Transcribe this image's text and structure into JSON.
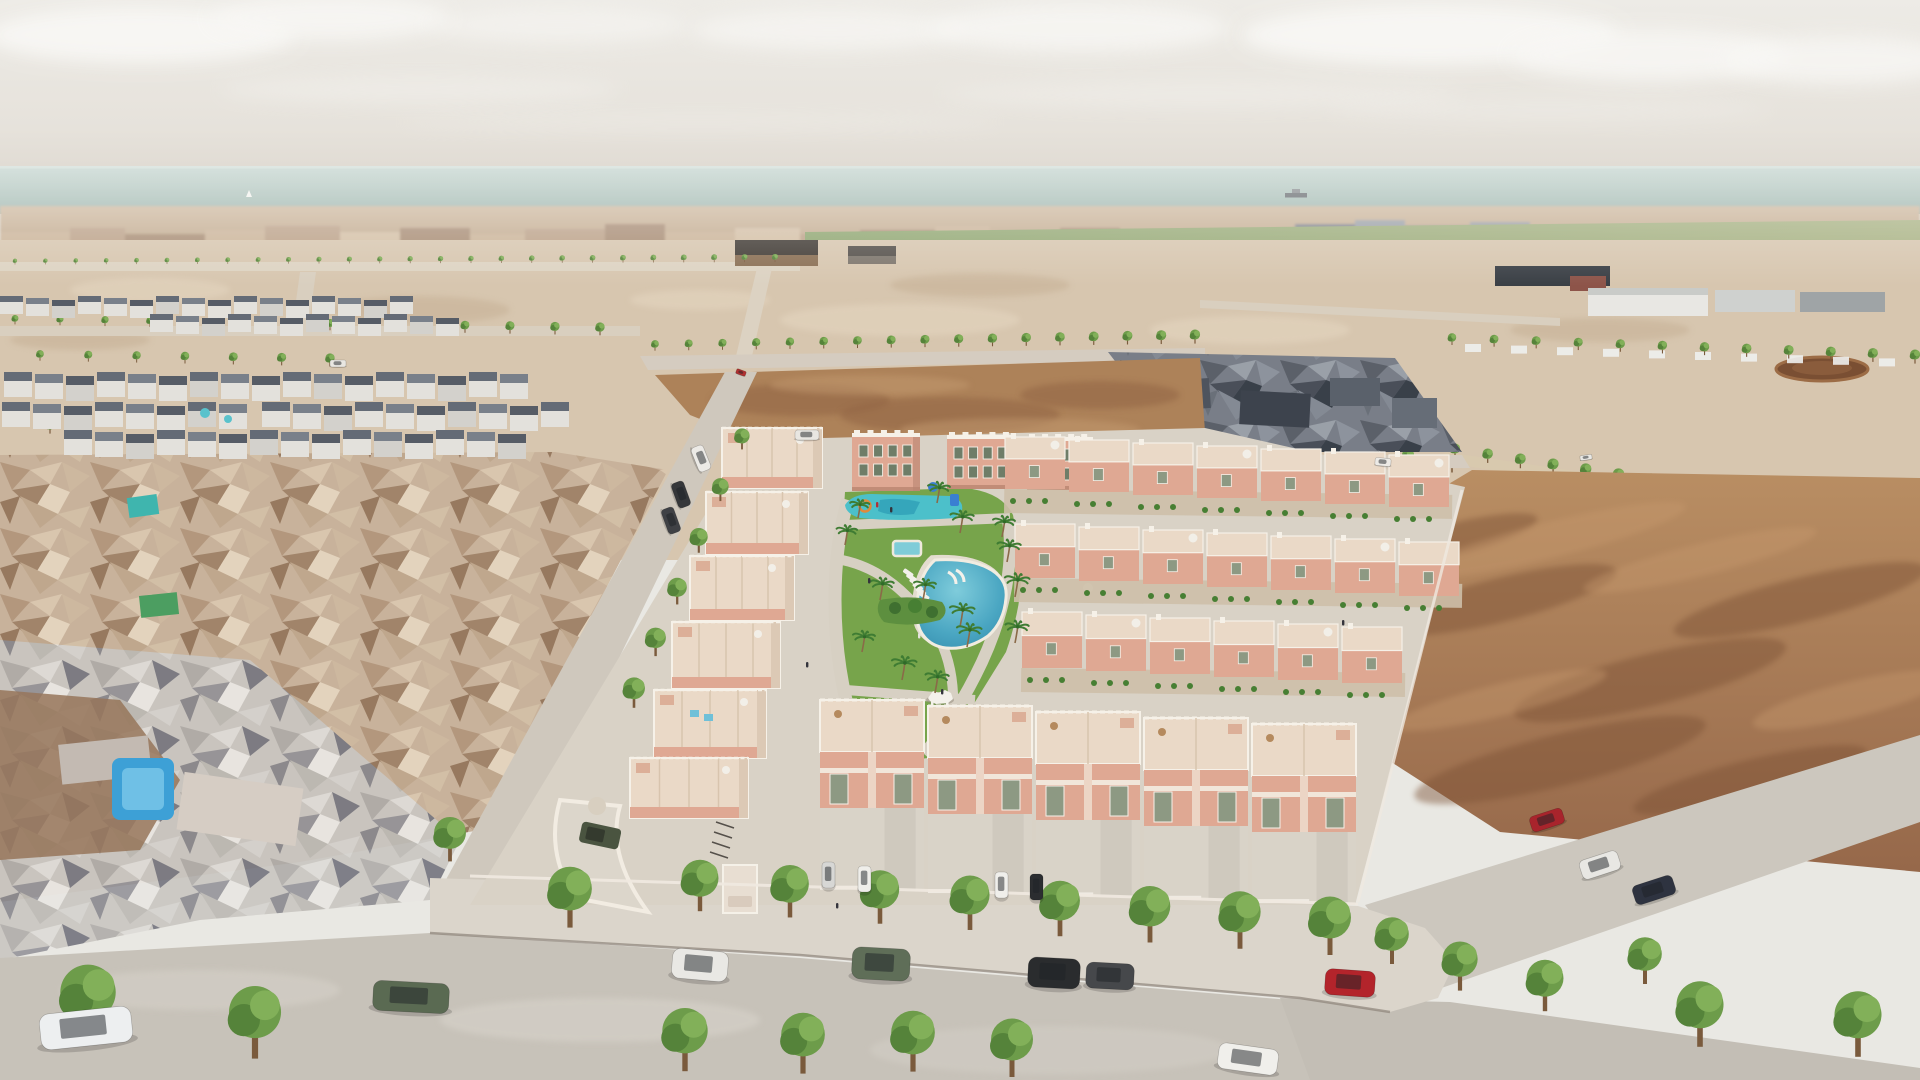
{
  "meta": {
    "title": "Aerial 3D architectural rendering of a coastal new-build residential development",
    "type": "architectural-visualization-render",
    "width": 1920,
    "height": 1080
  },
  "scene": {
    "description": "Bird's-eye daytime render of a gated new-build complex of salmon-pink townhouses and small apartment blocks arranged around a landscaped central park with a lagoon-style pool, a children's splash pool, a small rectangular pool and palm trees. An existing low-poly photogrammetry town sits to the west, vacant brown land to the east, farmland, greenhouses and industrial sheds in the midground, and a distant Mediterranean town with the sea, a cargo ship and a sailboat on the horizon. Tree-lined streets with parked cars border the development in the foreground.",
    "time_of_day": "hazy daylight",
    "counts": {
      "pools_in_park": 3,
      "apartment_towers": 3,
      "street_trees_foreground": 10,
      "parked_cars_foreground": 8
    }
  },
  "palette": {
    "skyTop": "#edebe6",
    "skyHorizon": "#e0dbd3",
    "cloud": "#f8f7f4",
    "seaTop": "#b4c9c1",
    "seaBottom": "#9ab2aa",
    "horizonLight": "#ccd8d1",
    "cityTan": "#c9b299",
    "industrialSlate": "#5d6570",
    "orchardGreen": "#7e9355",
    "fieldGreen": "#a3b07e",
    "sandLight": "#d7c6af",
    "sandPath": "#ddd3c2",
    "dirtBrown": "#a87c57",
    "dirtDark": "#8a603f",
    "dirtLight": "#c09a71",
    "roadGray": "#c7c2b9",
    "sidewalk": "#dbd5cb",
    "paving": "#d9d2c6",
    "curb": "#8d8379",
    "salmonWall": "#dfa893",
    "salmonShade": "#c8937f",
    "creamRoof": "#ead9c7",
    "whiteTrim": "#f6f1e8",
    "windowGreen": "#8d9983",
    "windowDark": "#6f7d68",
    "lawnGreen": "#77a44b",
    "bushGreen": "#477f33",
    "splashTeal": "#4cc0ca",
    "poolDeep": "#2f86a8",
    "poolMid": "#4aa6c2",
    "poolLight": "#7fccdb",
    "oldTownPool": "#3da0d6",
    "treeGreen": "#6d9c4a",
    "treeDark": "#55833a",
    "treeLight": "#82b059",
    "palmGreen": "#3f7c33",
    "trunkBrown": "#7a5a3c"
  },
  "objects": {
    "clouds": [
      [
        140,
        35,
        155,
        28,
        0.95
      ],
      [
        330,
        18,
        120,
        22,
        0.85
      ],
      [
        560,
        25,
        130,
        18,
        0.55
      ],
      [
        830,
        30,
        140,
        20,
        0.7
      ],
      [
        1080,
        28,
        150,
        24,
        0.8
      ],
      [
        1430,
        35,
        190,
        30,
        0.95
      ],
      [
        1650,
        55,
        140,
        26,
        0.85
      ],
      [
        1840,
        60,
        120,
        24,
        0.8
      ],
      [
        420,
        90,
        200,
        14,
        0.35
      ],
      [
        1200,
        95,
        260,
        14,
        0.3
      ],
      [
        700,
        122,
        300,
        10,
        0.22
      ],
      [
        1550,
        110,
        220,
        12,
        0.25
      ]
    ],
    "vessels": {
      "cargo_ship": {
        "x": 1296,
        "y": 196
      },
      "sailboat": {
        "x": 249,
        "y": 197
      }
    },
    "skyline": {
      "colors": [
        "#bca189",
        "#cbb49a",
        "#a88c75",
        "#d5c1a8",
        "#9aa0a8",
        "#7e848e"
      ],
      "segments": [
        [
          0,
          70,
          12,
          1
        ],
        [
          70,
          55,
          16,
          0
        ],
        [
          125,
          80,
          10,
          2
        ],
        [
          205,
          60,
          14,
          1
        ],
        [
          265,
          75,
          18,
          0
        ],
        [
          340,
          60,
          12,
          3
        ],
        [
          400,
          70,
          16,
          2
        ],
        [
          470,
          55,
          10,
          1
        ],
        [
          525,
          80,
          15,
          0
        ],
        [
          605,
          60,
          20,
          2
        ],
        [
          665,
          70,
          12,
          1
        ],
        [
          735,
          65,
          16,
          3
        ],
        [
          800,
          60,
          10,
          0
        ],
        [
          860,
          75,
          14,
          2
        ],
        [
          935,
          55,
          18,
          1
        ],
        [
          990,
          70,
          12,
          0
        ],
        [
          1060,
          60,
          16,
          2
        ],
        [
          1120,
          70,
          10,
          1
        ],
        [
          1190,
          60,
          14,
          3
        ],
        [
          1250,
          45,
          12,
          0
        ],
        [
          1295,
          60,
          20,
          5
        ],
        [
          1355,
          50,
          24,
          4
        ],
        [
          1405,
          65,
          18,
          5
        ],
        [
          1470,
          60,
          22,
          4
        ],
        [
          1530,
          70,
          14,
          1
        ],
        [
          1600,
          70,
          16,
          4
        ],
        [
          1670,
          60,
          12,
          1
        ],
        [
          1730,
          70,
          14,
          2
        ],
        [
          1800,
          60,
          12,
          4
        ],
        [
          1860,
          60,
          14,
          2
        ]
      ]
    },
    "treeRows": [
      {
        "name": "orchard-palm-row",
        "layer": "far",
        "x0": 15,
        "y0": 263,
        "x1": 775,
        "y1": 260,
        "n": 26,
        "s0": 5,
        "s1": 7
      },
      {
        "name": "upper-left-row",
        "layer": "far",
        "x0": 15,
        "y0": 322,
        "x1": 600,
        "y1": 332,
        "n": 14,
        "s0": 8,
        "s1": 11
      },
      {
        "name": "upper-left-row2",
        "layer": "far",
        "x0": 40,
        "y0": 358,
        "x1": 330,
        "y1": 363,
        "n": 7,
        "s0": 9,
        "s1": 11
      },
      {
        "name": "top-road-row",
        "layer": "far",
        "x0": 655,
        "y0": 348,
        "x1": 1195,
        "y1": 340,
        "n": 17,
        "s0": 9,
        "s1": 12
      },
      {
        "name": "ne-cluster-road-row",
        "layer": "far",
        "x0": 1232,
        "y0": 436,
        "x1": 1452,
        "y1": 468,
        "n": 6,
        "s0": 12,
        "s1": 15
      },
      {
        "name": "stall-row",
        "layer": "far",
        "x0": 1452,
        "y0": 342,
        "x1": 1915,
        "y1": 360,
        "n": 12,
        "s0": 10,
        "s1": 12
      },
      {
        "name": "east-road-row",
        "layer": "far",
        "x0": 1455,
        "y0": 454,
        "x1": 1880,
        "y1": 522,
        "n": 14,
        "s0": 12,
        "s1": 16
      },
      {
        "name": "field-west-edge-row",
        "layer": "far",
        "x0": 1362,
        "y0": 560,
        "x1": 1398,
        "y1": 730,
        "n": 5,
        "s0": 16,
        "s1": 20
      },
      {
        "name": "left-road-row",
        "layer": "near",
        "x0": 742,
        "y0": 444,
        "x1": 634,
        "y1": 700,
        "n": 6,
        "s0": 18,
        "s1": 26
      },
      {
        "name": "sidewalk-row",
        "layer": "near",
        "x0": 700,
        "y0": 898,
        "x1": 1330,
        "y1": 940,
        "n": 8,
        "s0": 44,
        "s1": 50
      }
    ],
    "treesFar": [
      [
        50,
        430,
        12
      ],
      [
        88,
        520,
        14
      ],
      [
        205,
        468,
        13
      ],
      [
        262,
        558,
        16
      ],
      [
        325,
        608,
        16
      ],
      [
        152,
        648,
        15
      ],
      [
        232,
        688,
        15
      ],
      [
        332,
        718,
        16
      ],
      [
        422,
        658,
        15
      ],
      [
        392,
        478,
        12
      ],
      [
        468,
        418,
        11
      ],
      [
        520,
        562,
        14
      ],
      [
        480,
        612,
        15
      ],
      [
        545,
        500,
        13
      ],
      [
        820,
        505,
        12
      ],
      [
        812,
        560,
        13
      ],
      [
        800,
        615,
        14
      ],
      [
        790,
        672,
        15
      ],
      [
        782,
        725,
        15
      ],
      [
        1170,
        472,
        12
      ],
      [
        1210,
        488,
        12
      ],
      [
        1310,
        472,
        11
      ],
      [
        1425,
        498,
        12
      ],
      [
        1500,
        532,
        13
      ]
    ],
    "treesNear": [
      [
        88,
        1022,
        66
      ],
      [
        255,
        1040,
        62
      ],
      [
        450,
        850,
        38
      ],
      [
        570,
        912,
        52
      ],
      [
        685,
        1055,
        54
      ],
      [
        803,
        1058,
        52
      ],
      [
        913,
        1056,
        52
      ],
      [
        1012,
        1062,
        50
      ],
      [
        1392,
        952,
        40
      ],
      [
        1460,
        978,
        42
      ],
      [
        1545,
        998,
        44
      ],
      [
        1645,
        972,
        40
      ],
      [
        1700,
        1030,
        56
      ],
      [
        1858,
        1040,
        56
      ]
    ],
    "palms": [
      [
        937,
        503,
        16
      ],
      [
        960,
        533,
        17
      ],
      [
        1002,
        537,
        16
      ],
      [
        1007,
        562,
        17
      ],
      [
        1015,
        597,
        18
      ],
      [
        880,
        600,
        17
      ],
      [
        923,
        600,
        16
      ],
      [
        960,
        627,
        18
      ],
      [
        967,
        647,
        18
      ],
      [
        1015,
        643,
        17
      ],
      [
        862,
        652,
        16
      ],
      [
        845,
        545,
        15
      ],
      [
        858,
        518,
        14
      ],
      [
        902,
        680,
        18
      ],
      [
        935,
        693,
        17
      ]
    ],
    "cars": [
      {
        "x": 373,
        "y": 982,
        "w": 76,
        "h": 30,
        "c": "#5a6a52",
        "r": 3,
        "kind": "green-suv"
      },
      {
        "x": 672,
        "y": 950,
        "w": 56,
        "h": 30,
        "c": "#e9e8e4",
        "r": 5,
        "kind": "white-suv"
      },
      {
        "x": 852,
        "y": 948,
        "w": 58,
        "h": 32,
        "c": "#5f6e58",
        "r": 3,
        "kind": "green-suv"
      },
      {
        "x": 1028,
        "y": 958,
        "w": 52,
        "h": 30,
        "c": "#2a2c2e",
        "r": 3,
        "kind": "black-suv"
      },
      {
        "x": 1086,
        "y": 963,
        "w": 48,
        "h": 26,
        "c": "#46484b",
        "r": 3,
        "kind": "gray-sedan"
      },
      {
        "x": 1325,
        "y": 970,
        "w": 50,
        "h": 26,
        "c": "#b3242b",
        "r": 4,
        "kind": "red-hatchback"
      },
      {
        "x": 1218,
        "y": 1046,
        "w": 60,
        "h": 26,
        "c": "#f0efeb",
        "r": 8,
        "kind": "white-coupe"
      },
      {
        "x": 40,
        "y": 1010,
        "w": 92,
        "h": 36,
        "c": "#edeff0",
        "r": -6,
        "kind": "white-sports-car"
      },
      {
        "x": 688,
        "y": 452,
        "w": 26,
        "h": 13,
        "c": "#eceae6",
        "r": 68,
        "kind": "white-pickup"
      },
      {
        "x": 668,
        "y": 488,
        "w": 26,
        "h": 13,
        "c": "#35373a",
        "r": 70,
        "kind": "dark-suv"
      },
      {
        "x": 658,
        "y": 514,
        "w": 26,
        "h": 13,
        "c": "#3f4145",
        "r": 70,
        "kind": "dark-suv"
      },
      {
        "x": 736,
        "y": 370,
        "w": 10,
        "h": 5,
        "c": "#b03030",
        "r": 20,
        "kind": "distant-red-car"
      },
      {
        "x": 1580,
        "y": 855,
        "w": 40,
        "h": 20,
        "c": "#e8e7e3",
        "r": -18,
        "kind": "white-sedan"
      },
      {
        "x": 1633,
        "y": 880,
        "w": 42,
        "h": 20,
        "c": "#2e3340",
        "r": -18,
        "kind": "dark-sedan"
      },
      {
        "x": 1530,
        "y": 812,
        "w": 34,
        "h": 16,
        "c": "#a8242c",
        "r": -18,
        "kind": "red-car"
      },
      {
        "x": 822,
        "y": 862,
        "w": 13,
        "h": 26,
        "c": "#d7d7d5",
        "r": 0,
        "kind": "driveway-car"
      },
      {
        "x": 858,
        "y": 866,
        "w": 13,
        "h": 26,
        "c": "#efeeea",
        "r": 0,
        "kind": "driveway-car"
      },
      {
        "x": 995,
        "y": 872,
        "w": 13,
        "h": 26,
        "c": "#f0efeb",
        "r": 0,
        "kind": "driveway-car"
      },
      {
        "x": 1030,
        "y": 874,
        "w": 13,
        "h": 26,
        "c": "#2b2d30",
        "r": 0,
        "kind": "driveway-car"
      },
      {
        "x": 330,
        "y": 360,
        "w": 16,
        "h": 7,
        "c": "#e9e7e2",
        "r": 0,
        "kind": "distant-white-car"
      },
      {
        "x": 795,
        "y": 430,
        "w": 24,
        "h": 10,
        "c": "#e8e6e1",
        "r": 0,
        "kind": "white-van"
      },
      {
        "x": 1580,
        "y": 455,
        "w": 12,
        "h": 5,
        "c": "#e9e8e4",
        "r": -8,
        "kind": "distant-white-car"
      },
      {
        "x": 1375,
        "y": 458,
        "w": 16,
        "h": 8,
        "c": "#eceae6",
        "r": 5,
        "kind": "distant-white-car"
      }
    ],
    "apartments": {
      "towers": [
        {
          "x": 852,
          "y": 433,
          "w": 68,
          "h": 58
        },
        {
          "x": 947,
          "y": 435,
          "w": 68,
          "h": 54
        },
        {
          "x": 1027,
          "y": 437,
          "w": 66,
          "h": 53
        }
      ]
    },
    "leftBlocks": [
      {
        "x": 722,
        "y": 428,
        "w": 100,
        "h": 60
      },
      {
        "x": 706,
        "y": 492,
        "w": 102,
        "h": 62
      },
      {
        "x": 690,
        "y": 556,
        "w": 104,
        "h": 64
      },
      {
        "x": 672,
        "y": 622,
        "w": 108,
        "h": 66
      },
      {
        "x": 654,
        "y": 690,
        "w": 112,
        "h": 68
      },
      {
        "x": 630,
        "y": 758,
        "w": 118,
        "h": 60
      }
    ],
    "gridRows": [
      {
        "x": 1005,
        "y": 437,
        "n": 7,
        "uw": 64,
        "uh": 52,
        "tilt": 3
      },
      {
        "x": 1015,
        "y": 524,
        "n": 7,
        "uw": 64,
        "uh": 54,
        "tilt": 3
      },
      {
        "x": 1022,
        "y": 612,
        "n": 6,
        "uw": 64,
        "uh": 56,
        "tilt": 3
      }
    ],
    "bottomUnits": [
      {
        "x": 820,
        "y": 700
      },
      {
        "x": 928,
        "y": 706
      },
      {
        "x": 1036,
        "y": 712
      },
      {
        "x": 1144,
        "y": 718
      },
      {
        "x": 1252,
        "y": 724
      }
    ],
    "oldTownRows": [
      {
        "x": 0,
        "y": 296,
        "n": 16,
        "w": 26,
        "face": 12,
        "roof": 6
      },
      {
        "x": 150,
        "y": 314,
        "n": 12,
        "w": 26,
        "face": 12,
        "roof": 6
      },
      {
        "x": 4,
        "y": 372,
        "n": 17,
        "w": 31,
        "face": 16,
        "roof": 9
      },
      {
        "x": 262,
        "y": 402,
        "n": 10,
        "w": 31,
        "face": 16,
        "roof": 9
      },
      {
        "x": 2,
        "y": 402,
        "n": 8,
        "w": 31,
        "face": 16,
        "roof": 9
      },
      {
        "x": 64,
        "y": 430,
        "n": 15,
        "w": 31,
        "face": 16,
        "roof": 9
      }
    ],
    "loungers": {
      "x": 905,
      "y": 568,
      "n": 6,
      "dx": 3.2,
      "dy": 4.6,
      "rot": 35
    },
    "people": [
      [
        876,
        502,
        "#b03038"
      ],
      [
        890,
        507,
        "#34343c"
      ],
      [
        868,
        578,
        "#34343c"
      ],
      [
        918,
        633,
        "#e6e4de"
      ],
      [
        941,
        689,
        "#34343c"
      ],
      [
        806,
        662,
        "#34343c"
      ],
      [
        836,
        903,
        "#34343c"
      ],
      [
        1342,
        620,
        "#34343c"
      ]
    ],
    "midMottles": [
      [
        150,
        290,
        80,
        12,
        1
      ],
      [
        420,
        310,
        90,
        14,
        0
      ],
      [
        700,
        300,
        70,
        10,
        1
      ],
      [
        980,
        285,
        90,
        12,
        0
      ],
      [
        1250,
        330,
        100,
        14,
        1
      ],
      [
        1600,
        330,
        90,
        12,
        0
      ],
      [
        900,
        320,
        120,
        16,
        1
      ],
      [
        80,
        340,
        70,
        10,
        0
      ]
    ],
    "fieldStreaks": {
      "dark": [
        [
          1500,
          600,
          120,
          22
        ],
        [
          1650,
          680,
          140,
          26
        ],
        [
          1800,
          600,
          130,
          22
        ],
        [
          1560,
          760,
          150,
          26
        ],
        [
          1750,
          780,
          120,
          20
        ],
        [
          1450,
          540,
          90,
          16
        ]
      ],
      "light": [
        [
          1550,
          540,
          140,
          18
        ],
        [
          1700,
          560,
          120,
          16
        ],
        [
          1850,
          700,
          100,
          18
        ],
        [
          1500,
          700,
          110,
          16
        ]
      ]
    },
    "dirtPatchMottles": {
      "dark": [
        [
          800,
          400,
          90,
          16
        ],
        [
          950,
          415,
          110,
          18
        ],
        [
          1100,
          395,
          80,
          14
        ]
      ],
      "light": [
        [
          870,
          385,
          100,
          10
        ],
        [
          1020,
          430,
          120,
          12
        ]
      ]
    }
  }
}
